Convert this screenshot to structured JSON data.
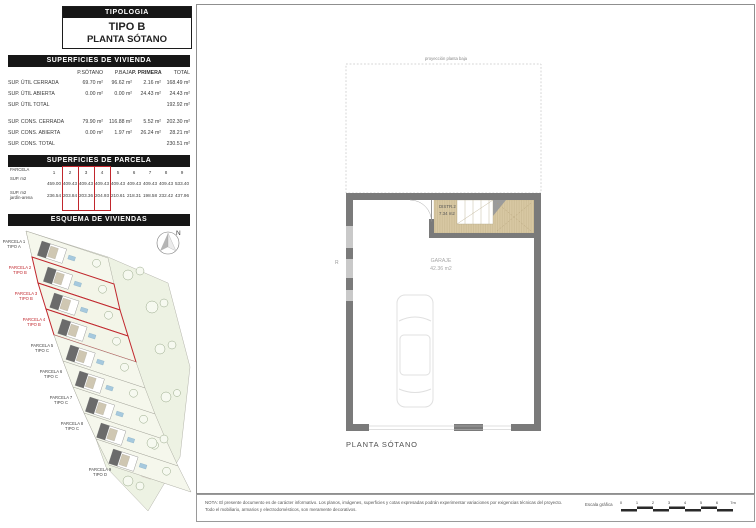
{
  "page": {
    "tipologia": "TIPOLOGIA",
    "tipo": "TIPO B",
    "planta": "PLANTA SÓTANO"
  },
  "vivienda_table": {
    "title": "SUPERFICIES DE VIVIENDA",
    "columns": [
      "",
      "P.SÓTANO",
      "P.BAJA",
      "P. PRIMERA",
      "TOTAL"
    ],
    "rows": [
      [
        "SUP. ÚTIL CERRADA",
        "69.70 m²",
        "96.62 m²",
        "2.16 m²",
        "168.49 m²"
      ],
      [
        "SUP. ÚTIL ABIERTA",
        "0.00 m²",
        "0.00 m²",
        "24.43 m²",
        "24.43 m²"
      ],
      [
        "SUP. ÚTIL TOTAL",
        "",
        "",
        "",
        "192.92 m²"
      ],
      [
        "SUP. CONS. CERRADA",
        "79.90 m²",
        "116.88 m²",
        "5.52 m²",
        "202.30 m²"
      ],
      [
        "SUP. CONS. ABIERTA",
        "0.00 m²",
        "1.97 m²",
        "26.24 m²",
        "28.21 m²"
      ],
      [
        "SUP. CONS. TOTAL",
        "",
        "",
        "",
        "230.51 m²"
      ]
    ]
  },
  "parcela_table": {
    "title": "SUPERFICIES DE PARCELA",
    "row_header_parcela": "PARCELA",
    "row_header_sup": "SUP. m2",
    "row_header_jardin_line1": "SUP. m2",
    "row_header_jardin_line2": "jardín-arena",
    "parcela_numbers": [
      "1",
      "2",
      "3",
      "4",
      "5",
      "6",
      "7",
      "8",
      "9"
    ],
    "sup_m2": [
      "459.00",
      "409.43",
      "409.43",
      "409.43",
      "409.43",
      "409.43",
      "409.43",
      "409.43",
      "533.40"
    ],
    "sup_m2_jardin": [
      "236.54",
      "203.84",
      "203.36",
      "204.93",
      "210.61",
      "218.31",
      "198.58",
      "232.42",
      "437.96"
    ],
    "highlighted_columns": [
      2,
      3,
      4
    ]
  },
  "esquema": {
    "title": "ESQUEMA DE VIVIENDAS",
    "north_label": "N",
    "parcels": [
      {
        "name": "PARCELA 1",
        "tipo": "TIPO A",
        "highlight": false
      },
      {
        "name": "PARCELA 2",
        "tipo": "TIPO B",
        "highlight": true
      },
      {
        "name": "PARCELA 3",
        "tipo": "TIPO B",
        "highlight": true
      },
      {
        "name": "PARCELA 4",
        "tipo": "TIPO B",
        "highlight": true
      },
      {
        "name": "PARCELA 5",
        "tipo": "TIPO C",
        "highlight": false
      },
      {
        "name": "PARCELA 6",
        "tipo": "TIPO C",
        "highlight": false
      },
      {
        "name": "PARCELA 7",
        "tipo": "TIPO C",
        "highlight": false
      },
      {
        "name": "PARCELA 8",
        "tipo": "TIPO C",
        "highlight": false
      },
      {
        "name": "PARCELA 9",
        "tipo": "TIPO D",
        "highlight": false
      }
    ]
  },
  "plan": {
    "projection_label": "proyección planta baja",
    "distr_name": "DISTR.2",
    "distr_area": "7.34 m2",
    "garaje_name": "GARAJE",
    "garaje_area": "42.36 m2",
    "vent_label": "R",
    "caption": "PLANTA SÓTANO"
  },
  "footer": {
    "nota_line1": "NOTA: El presente documento es de carácter informativo. Los planos, imágenes, superficies y cotas expresadas podrán experimentar variaciones por exigencias técnicas del proyecto.",
    "nota_line2": "Todo el mobiliario, armarios y electrodomésticos, son meramente decorativos.",
    "escala_label": "Escala gráfica",
    "escala_ticks": [
      "0",
      "1",
      "2",
      "3",
      "4",
      "5",
      "6",
      "7m"
    ]
  },
  "colors": {
    "accent_red": "#c1272d",
    "wall_gray": "#7a7a7a",
    "room_beige": "#d8c8a3",
    "bar_black": "#161616"
  }
}
